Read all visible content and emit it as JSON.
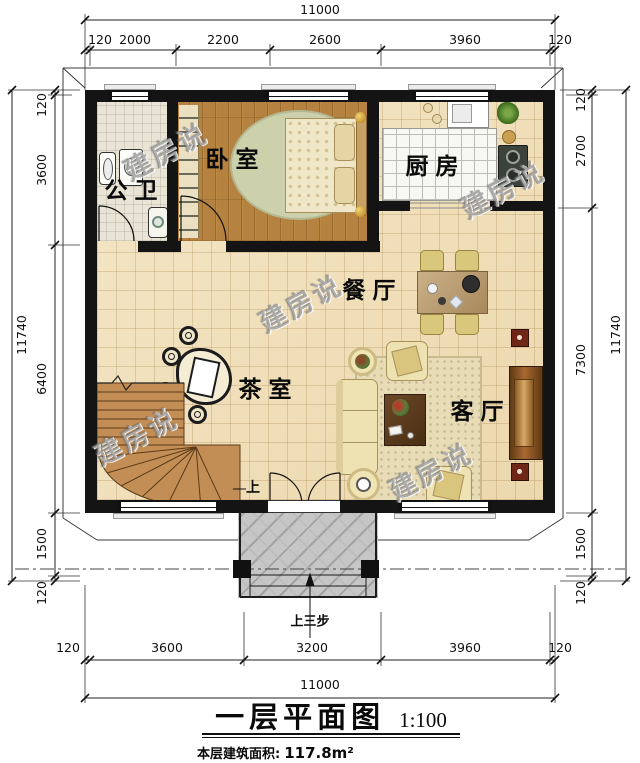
{
  "plan": {
    "title": "一层平面图",
    "scale": "1:100",
    "area_label": "本层建筑面积:",
    "area_value": "117.8m²"
  },
  "watermark": "建房说",
  "rooms": {
    "bathroom": "公卫",
    "bedroom": "卧室",
    "kitchen": "厨房",
    "dining": "餐厅",
    "tea_room": "茶室",
    "living": "客厅"
  },
  "annotations": {
    "stairs_up": "上",
    "entrance_steps": "上三步"
  },
  "dimensions": {
    "top": {
      "total": "11000",
      "segments": [
        "120",
        "2000",
        "2200",
        "2600",
        "3960",
        "120"
      ]
    },
    "bottom": {
      "total": "11000",
      "segments": [
        "120",
        "3600",
        "3200",
        "3960",
        "120"
      ]
    },
    "left": {
      "total": "11740",
      "segments": [
        "120",
        "3600",
        "6400",
        "1500",
        "120"
      ]
    },
    "right": {
      "total": "11740",
      "segments": [
        "120",
        "2700",
        "7300",
        "1500",
        "120"
      ]
    }
  },
  "colors": {
    "wall": "#141414",
    "tile_floor": "#f1e2c0",
    "wood_floor": "#b5823f",
    "porch_floor": "#c6c6c6",
    "stairs": "#c28e55"
  }
}
